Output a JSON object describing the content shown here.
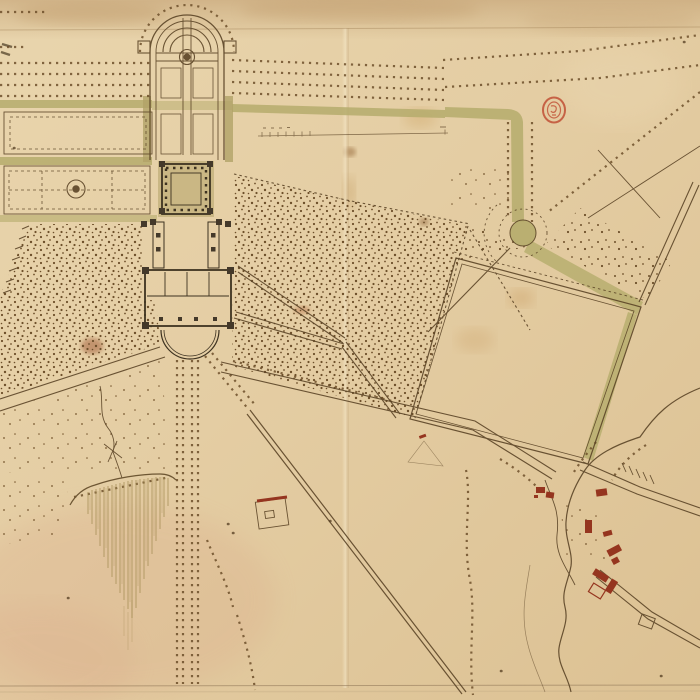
{
  "document": {
    "kind": "manuscript estate plan",
    "description": "Hand-drawn ink and wash plan on aged folded paper: chateau with forecourt, apsidal walled garden, parterres with basins, tree allees, wooded bosquets with diagonal rides, a rond-point on a green ride, a large enclosed field, a hachured slope, winding streams and a hamlet of red buildings",
    "legible_text": ""
  },
  "palette": {
    "paper": "#e4cda3",
    "paper_light": "#eedbb6",
    "paper_shadow": "#cfb287",
    "ink": "#5c4527",
    "ink_dark": "#3d3220",
    "tree_dot": "#6d4f2a",
    "wash_green": "#b5ac6c",
    "wash_olive": "#b2a268",
    "building_dark": "#44392a",
    "red_building": "#95351f",
    "stamp_red": "#c14f35",
    "hachure": "#a28a52",
    "stain_brown": "#8a5a2b",
    "stain_pink": "#d69a7e"
  },
  "features": {
    "upper_walled_garden": "apsidal walled garden with round basin and quartered beds",
    "parterre_panels": "two long parterre panels, lower one with circular basin",
    "tree_allees": "dotted rows of planted trees",
    "cloister_court": "square colonnaded court",
    "wing_colonnades": "twin colonnade wings flanking inner court",
    "chateau_block": "main dwelling block with corner pavilions",
    "forecourt": "semicircular entrance court",
    "goose_foot": "avenues radiating from the forecourt",
    "east_bosquet": "large dotted wooded quarter with diagonal rides",
    "rond_point": "circular green carrefour",
    "green_rides": "green washed riding avenues",
    "great_field": "large tilted enclosed field",
    "cascade_slope": "hachured steep slope below stream",
    "hamlet": "cluster of small red buildings along stream",
    "streams": "winding watercourses",
    "scale_bar": "small scale line with tick marks (figures illegible)",
    "collection_stamp": "small red oval library stamp"
  }
}
